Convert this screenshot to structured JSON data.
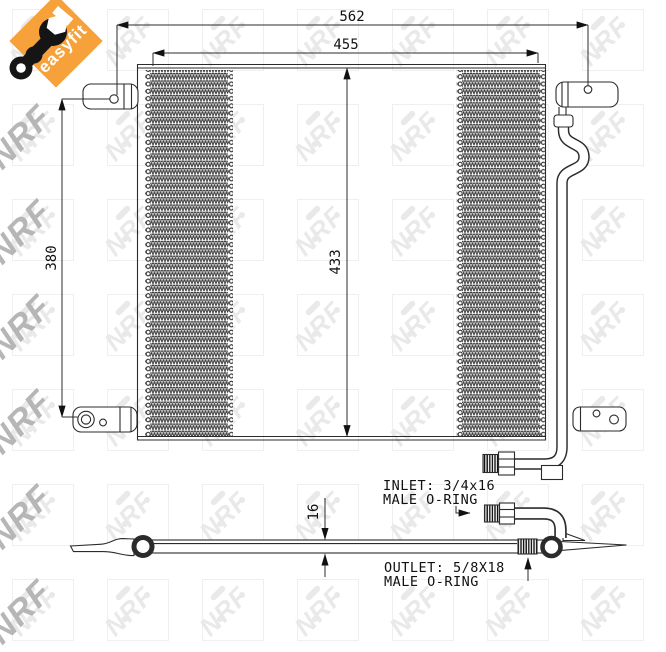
{
  "badge": {
    "label": "easyfit",
    "background_color": "#F7A13B",
    "text_color": "#ffffff",
    "icon": "wrench-icon"
  },
  "watermark": {
    "text": "NRF",
    "tile_color": "#e9e9e9",
    "edge_color": "#b6b6b6"
  },
  "dimensions": {
    "mount_width": "562",
    "core_width": "455",
    "mount_height": "380",
    "core_height": "433",
    "thickness": "16"
  },
  "labels": {
    "inlet_line1": "INLET: 3/4x16",
    "inlet_line2": "MALE O-RING",
    "outlet_line1": "OUTLET: 5/8X18",
    "outlet_line2": "MALE O-RING"
  },
  "colors": {
    "line": "#2b2b2b",
    "text": "#111111"
  }
}
